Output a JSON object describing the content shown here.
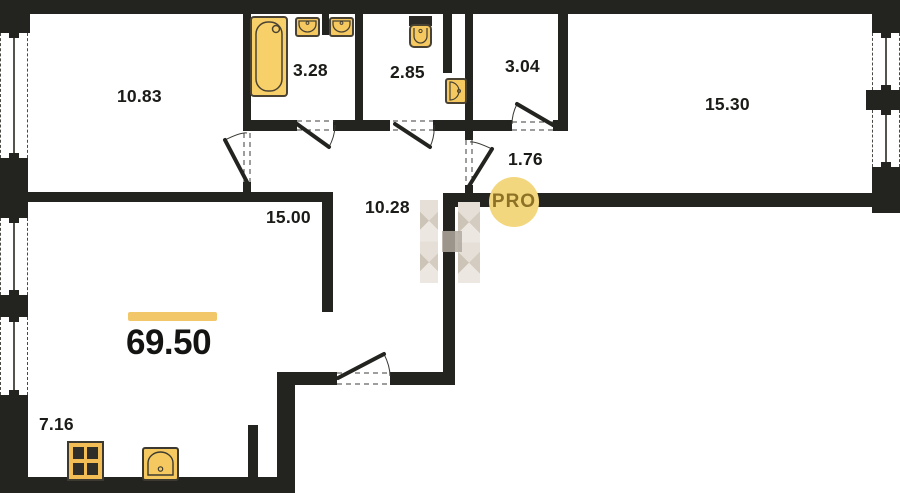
{
  "total_area": "69.50",
  "badge_label": "PRO",
  "room_areas": {
    "room_10_83": "10.83",
    "bath_3_28": "3.28",
    "wc_2_85": "2.85",
    "storage_3_04": "3.04",
    "bedroom_15_30": "15.30",
    "entry_1_76": "1.76",
    "hall_10_28": "10.28",
    "living_15_00": "15.00",
    "kitchen_7_16": "7.16"
  },
  "fixtures": [
    "bathtub",
    "washbasin",
    "washbasin",
    "toilet",
    "washbasin",
    "stove",
    "kitchen-sink"
  ],
  "colors": {
    "wall": "#232320",
    "fixture_fill": "#f6c960",
    "fixture_border": "#4a4334",
    "accent_bar": "#f2c76a",
    "badge_bg": "#f3d77e",
    "badge_text": "#8d7125",
    "background": "#ffffff"
  }
}
